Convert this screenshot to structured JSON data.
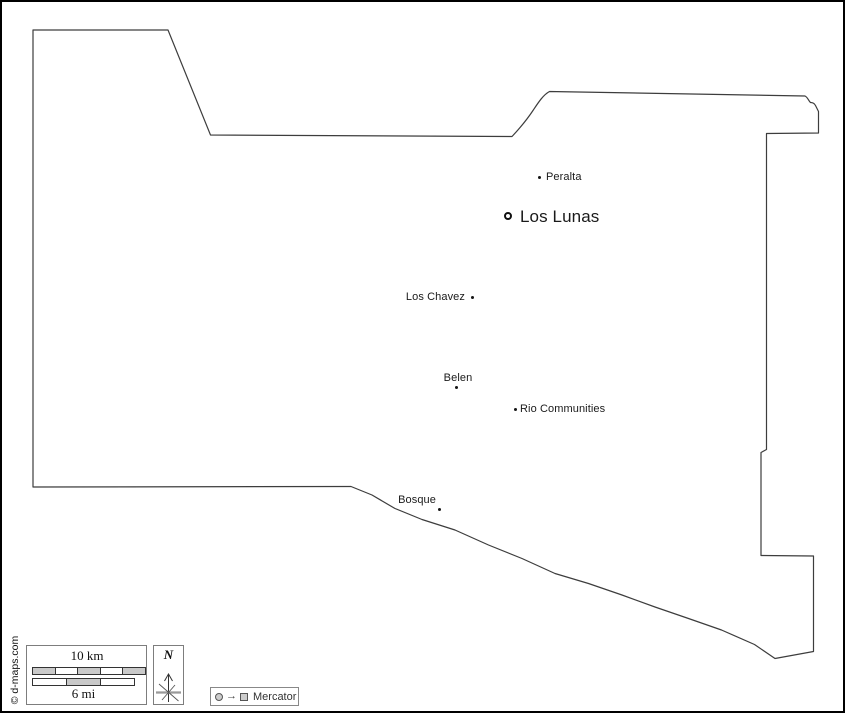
{
  "map": {
    "title": "Valencia County outline map",
    "outline_color": "#3d3d3d",
    "background": "#ffffff",
    "cities": [
      {
        "name": "Peralta",
        "marker": "dot",
        "label_side": "right"
      },
      {
        "name": "Los Lunas",
        "marker": "ring",
        "label_side": "right",
        "emphasis": "large"
      },
      {
        "name": "Los Chavez",
        "marker": "dot",
        "label_side": "left"
      },
      {
        "name": "Belen",
        "marker": "dot",
        "label_side": "above"
      },
      {
        "name": "Rio Communities",
        "marker": "dot",
        "label_side": "right"
      },
      {
        "name": "Bosque",
        "marker": "dot",
        "label_side": "left"
      }
    ]
  },
  "legend": {
    "scale": {
      "km_label": "10 km",
      "mi_label": "6 mi",
      "km_segments": 5,
      "mi_segments": 3
    },
    "north_label": "N",
    "projection_label": "Mercator",
    "attribution": "© d-maps.com"
  },
  "colors": {
    "outline": "#3d3d3d",
    "text": "#1a1a1a",
    "legend_border": "#7d7d7d",
    "bar_fill_gray": "#c9c9c9",
    "bar_fill_white": "#ffffff",
    "compass_bar": "#999999"
  }
}
